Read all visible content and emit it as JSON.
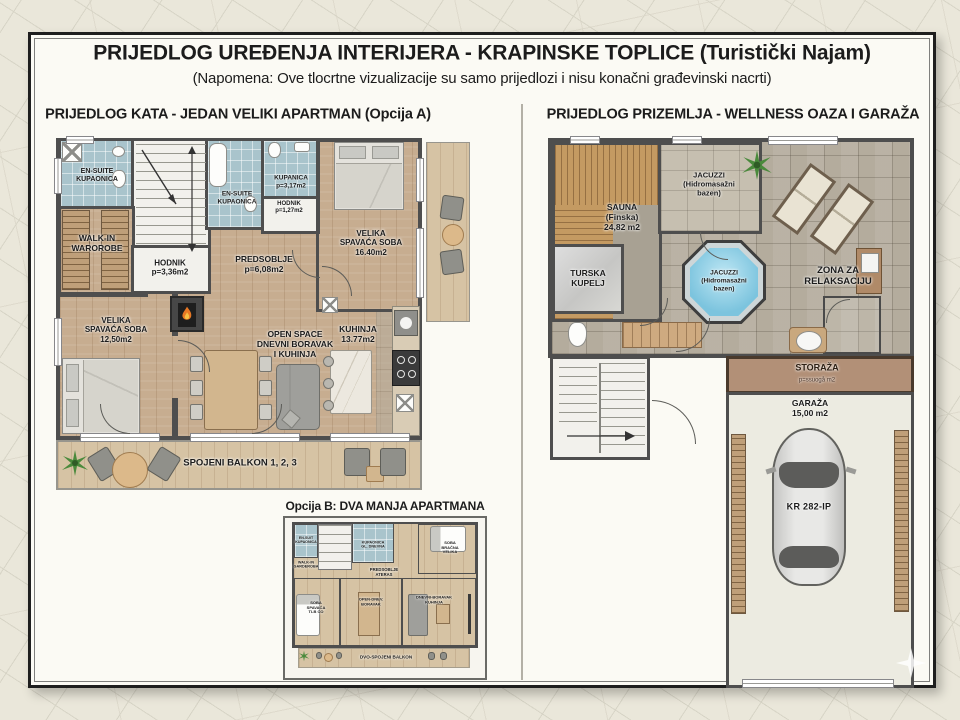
{
  "header": {
    "title": "PRIJEDLOG UREĐENJA INTERIJERA - KRAPINSKE TOPLICE (Turistički Najam)",
    "subtitle": "(Napomena: Ove tlocrtne vizualizacije su samo prijedlozi i nisu konačni građevinski nacrti)"
  },
  "plan_a": {
    "header": "PRIJEDLOG KATA - JEDAN VELIKI APARTMAN (Opcija A)",
    "rooms": {
      "ensuite_1": "EN-SUITE\nKUPAONICA",
      "walk_in": "WALK-IN\nWAROROBE",
      "hodnik_1": "HODNIK\np=3,36m2",
      "ensuite_2": "EN-SUITE\nKUPAONICA",
      "kupanica": "KUPANICA\np=3,17m2",
      "hodnik_2": "HODNIK\np=1,27m2",
      "spavaca_velika": "VELIKA\nSPAVAĆA SOBA\n16.40m2",
      "predsoblje": "PREDSOBLJE\np=6,08m2",
      "spavaca_mala": "VELIKA\nSPAVAĆA SOBA\n12,50m2",
      "open_space": "OPEN SPACE\nDNEVNI BORAVAK\nI KUHINJA",
      "kuhinja": "KUHINJA\n13.77m2",
      "balkon": "SPOJENI BALKON 1, 2, 3"
    }
  },
  "plan_b": {
    "header": "Opcija B: DVA MANJA APARTMANA",
    "rooms": {
      "ensuite": "EN-SUIT\nKUPAONICA",
      "garderoba": "WALK-IN\nGARDEROBA",
      "kupaonica": "KUPAONICA\nGL. DNEVNA",
      "predsoblje": "PREDSOBLJE\nATERAS",
      "soba_velika": "SOBA\nBRAČNA\nVELIKA",
      "soba_dnevna": "SOBA\nSPAVAĆA\nTLB CO",
      "dnevni_1": "OPEN-DNEV.\nBORAVAK",
      "dnevni_2": "DNEVNI-BORAVAK\nKUHINJA",
      "balkon": "DVO-SPOJENI BALKON"
    }
  },
  "plan_prizemlje": {
    "header": "PRIJEDLOG PRIZEMLJA - WELLNESS OAZA I GARAŽA",
    "rooms": {
      "sauna": "SAUNA\n(Finska)\n24,82 m2",
      "jacuzzi_room": "JACUZZI\n(Hidromasažni\nbazen)",
      "turska": "TURSKA\nKUPELJ",
      "jacuzzi_pool": "JACUZZI\n(Hidromasažni\nbazen)",
      "zona": "ZONA ZA\nRELAKSACIJU",
      "storaza": "STORAŽA",
      "storaza_sub": "p=ssuogå m2",
      "garaza": "GARAŽA\n15,00 m2",
      "license_plate": "KR 282-IP"
    }
  },
  "colors": {
    "wall": "#4e4e4e",
    "wood": "#c7ad90",
    "wood_light": "#d6c3a4",
    "bath_blue": "#a9c4cc",
    "tile_gray": "#b4ac9d",
    "pool_blue": "#7cc4de",
    "sauna_wood": "#c49a62",
    "storage_brown": "#b29077",
    "flame_orange": "#e87824",
    "plant_green": "#4a8a3c",
    "paper": "#fbfaf4",
    "map_bg": "#eae7da"
  }
}
